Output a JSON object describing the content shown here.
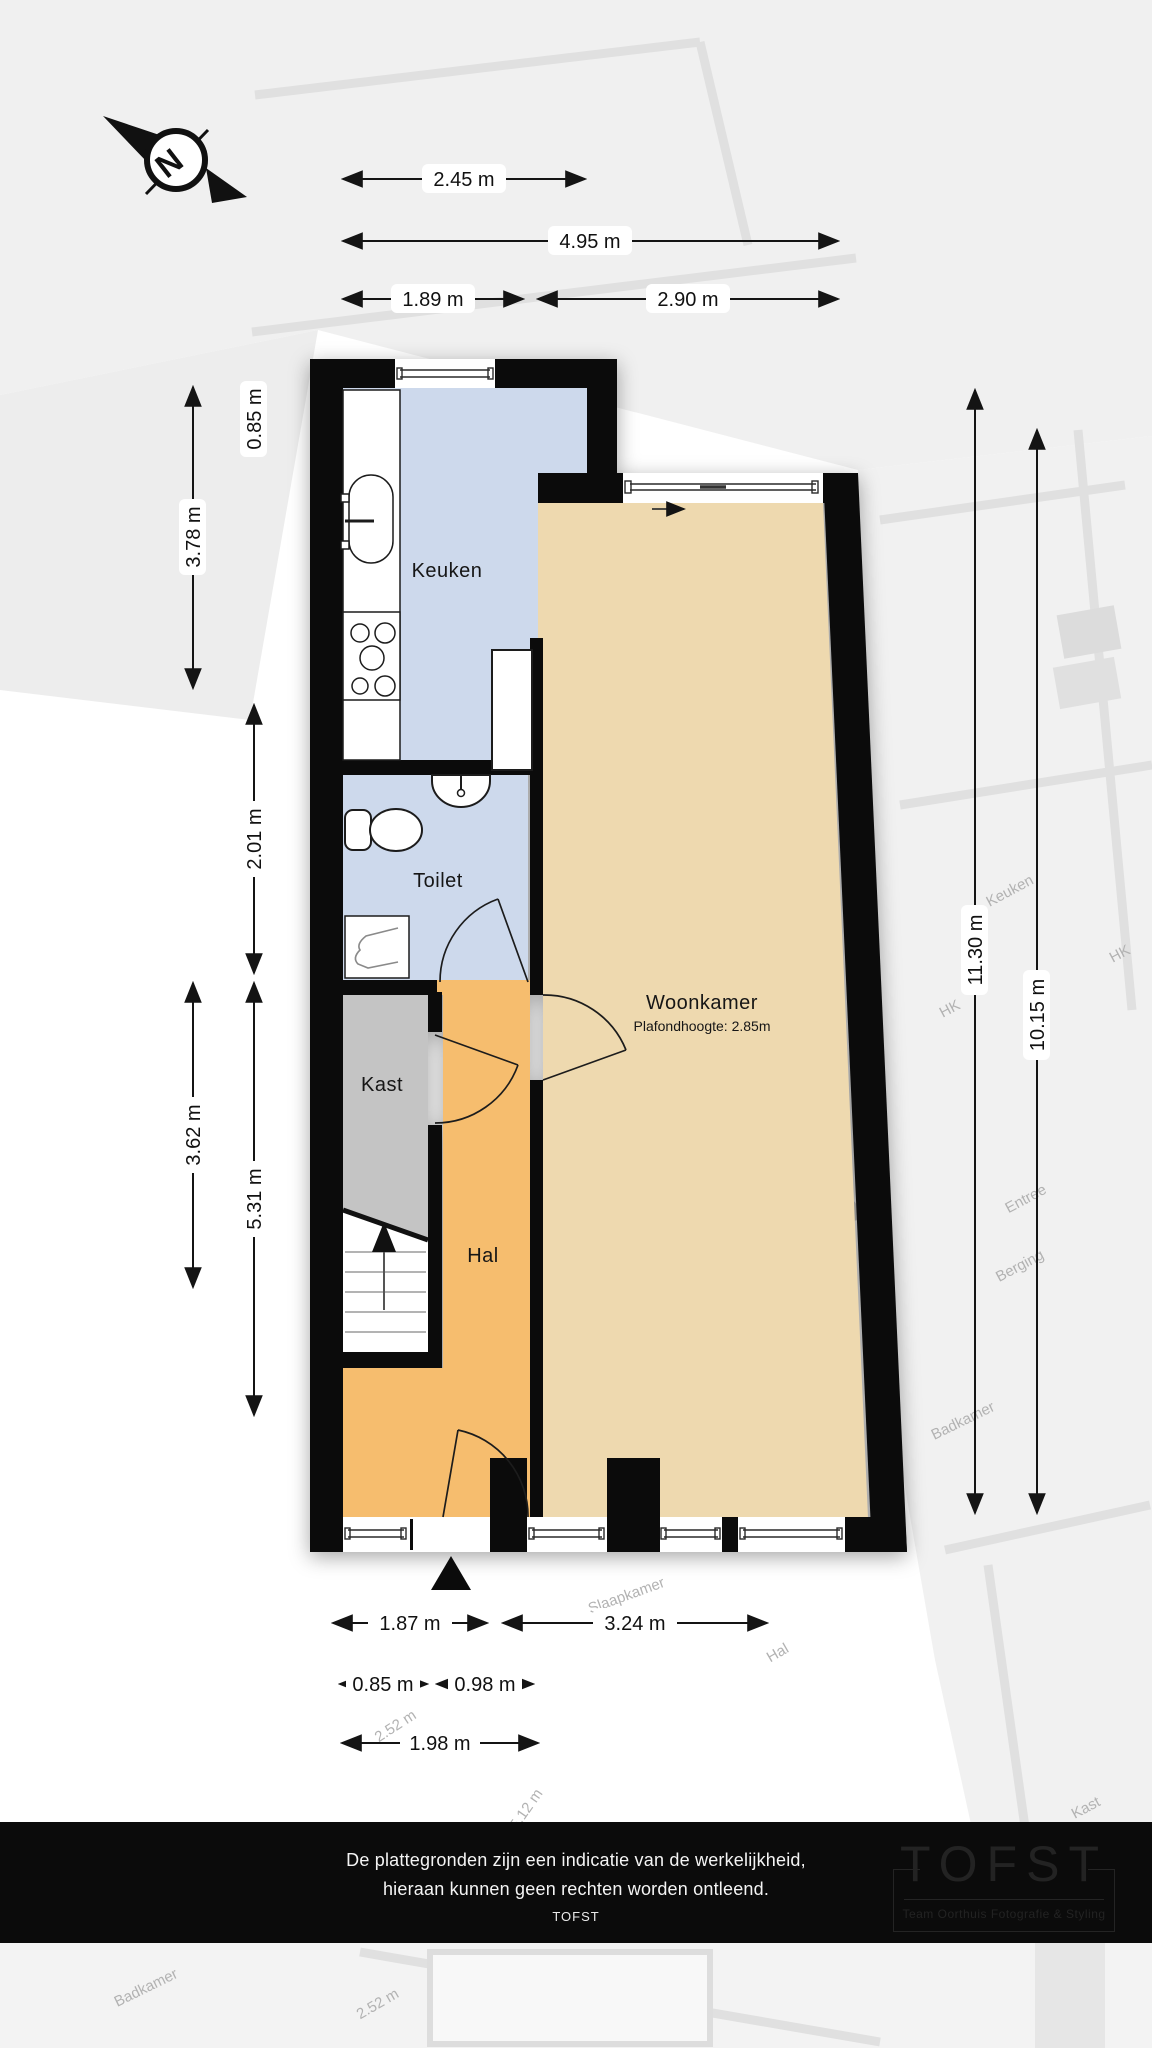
{
  "compass": {
    "north_label": "N"
  },
  "rooms": {
    "keuken": {
      "label": "Keuken"
    },
    "toilet": {
      "label": "Toilet"
    },
    "kast": {
      "label": "Kast"
    },
    "hal": {
      "label": "Hal"
    },
    "woonkamer": {
      "label": "Woonkamer",
      "ceiling_note": "Plafondhoogte: 2.85m"
    }
  },
  "dimensions": {
    "top": [
      {
        "label": "2.45 m"
      },
      {
        "label": "4.95 m"
      },
      {
        "label": "1.89 m"
      },
      {
        "label": "2.90 m"
      }
    ],
    "left": [
      {
        "label": "0.85 m"
      },
      {
        "label": "3.78 m"
      },
      {
        "label": "2.01 m"
      },
      {
        "label": "3.62 m"
      },
      {
        "label": "5.31 m"
      }
    ],
    "right": [
      {
        "label": "11.30 m"
      },
      {
        "label": "10.15 m"
      }
    ],
    "bottom": [
      {
        "label": "1.87 m"
      },
      {
        "label": "3.24 m"
      },
      {
        "label": "0.85 m"
      },
      {
        "label": "0.98 m"
      },
      {
        "label": "1.98 m"
      }
    ]
  },
  "background_plan": {
    "labels": [
      {
        "text": "Keuken"
      },
      {
        "text": "HK"
      },
      {
        "text": "HK"
      },
      {
        "text": "Entree"
      },
      {
        "text": "Berging"
      },
      {
        "text": "Badkamer"
      },
      {
        "text": "Slaapkamer"
      },
      {
        "text": "Hal"
      },
      {
        "text": "Kast"
      },
      {
        "text": "Badkamer"
      },
      {
        "text": "5.12 m"
      },
      {
        "text": "2.52 m"
      },
      {
        "text": "2.52 m"
      }
    ]
  },
  "disclaimer": {
    "line1": "De plattegronden zijn een indicatie van de werkelijkheid,",
    "line2": "hieraan kunnen geen rechten worden ontleend.",
    "brand": "TOFST"
  },
  "logo": {
    "name": "TOFST",
    "tagline": "Team Oorthuis Fotografie & Styling"
  },
  "colors": {
    "keuken_fill": "#cdd9ec",
    "toilet_fill": "#cdd9ec",
    "kast_fill": "#c4c4c4",
    "hal_fill": "#f6bd6e",
    "woonkamer_fill": "#eed9af",
    "wall": "#0b0b0b",
    "dimension_ink": "#141414",
    "disclaimer_bg": "#0b0b0b",
    "logo_ink": "#232323",
    "watermark_ink": "#b2b2b2"
  }
}
